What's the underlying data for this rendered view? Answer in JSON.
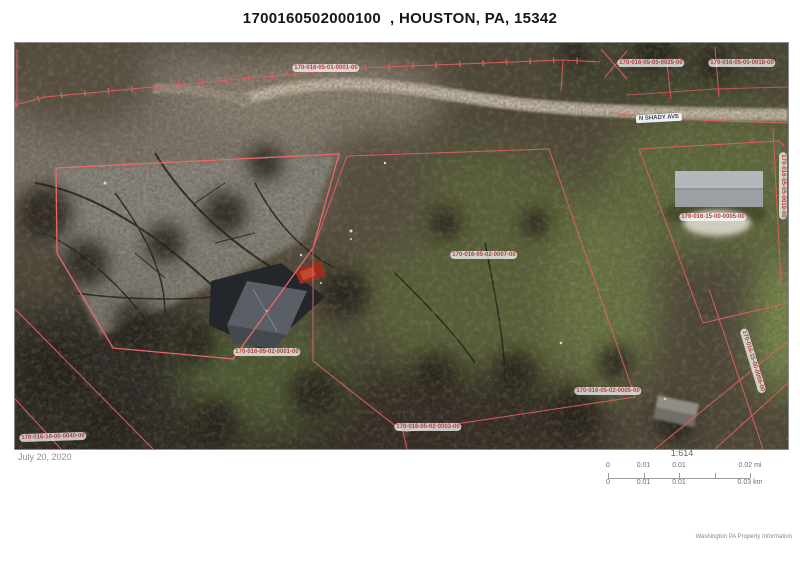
{
  "page": {
    "title": "1700160502000100  , HOUSTON, PA, 15342"
  },
  "map": {
    "road_label": "N SHADY AVE",
    "line_color": "#e25f5f",
    "label_color": "#b04040",
    "parcel_labels": [
      {
        "text": "170-016-05-01-0001-00",
        "x": 311,
        "y": 25,
        "rot": 0
      },
      {
        "text": "170-016-05-05-0025-00",
        "x": 636,
        "y": 20,
        "rot": 0
      },
      {
        "text": "170-016-05-05-0018-00",
        "x": 727,
        "y": 20,
        "rot": 0
      },
      {
        "text": "170-016-05-05-0019-00",
        "x": 768,
        "y": 143,
        "rot": 90
      },
      {
        "text": "170-016-15-00-0005-00",
        "x": 698,
        "y": 174,
        "rot": 0
      },
      {
        "text": "170-016-15-00-0006-00",
        "x": 738,
        "y": 318,
        "rot": 73
      },
      {
        "text": "170-016-05-02-0007-00",
        "x": 469,
        "y": 212,
        "rot": 0
      },
      {
        "text": "170-016-05-02-0001-00",
        "x": 252,
        "y": 309,
        "rot": 0
      },
      {
        "text": "170-016-05-02-0005-00",
        "x": 593,
        "y": 348,
        "rot": 0
      },
      {
        "text": "170-016-05-02-0003-00",
        "x": 413,
        "y": 384,
        "rot": 0
      },
      {
        "text": "170-016-18-00-0040-00",
        "x": 38,
        "y": 394,
        "rot": -2
      }
    ]
  },
  "footer": {
    "date": "July 20, 2020",
    "scale_ratio": "1:614",
    "scale_mi": [
      "0",
      "0.01",
      "0.01",
      "0.02 mi"
    ],
    "scale_km": [
      "0",
      "0.01",
      "0.01",
      "0.03 km"
    ],
    "attribution": "Washington PA Property Information"
  }
}
